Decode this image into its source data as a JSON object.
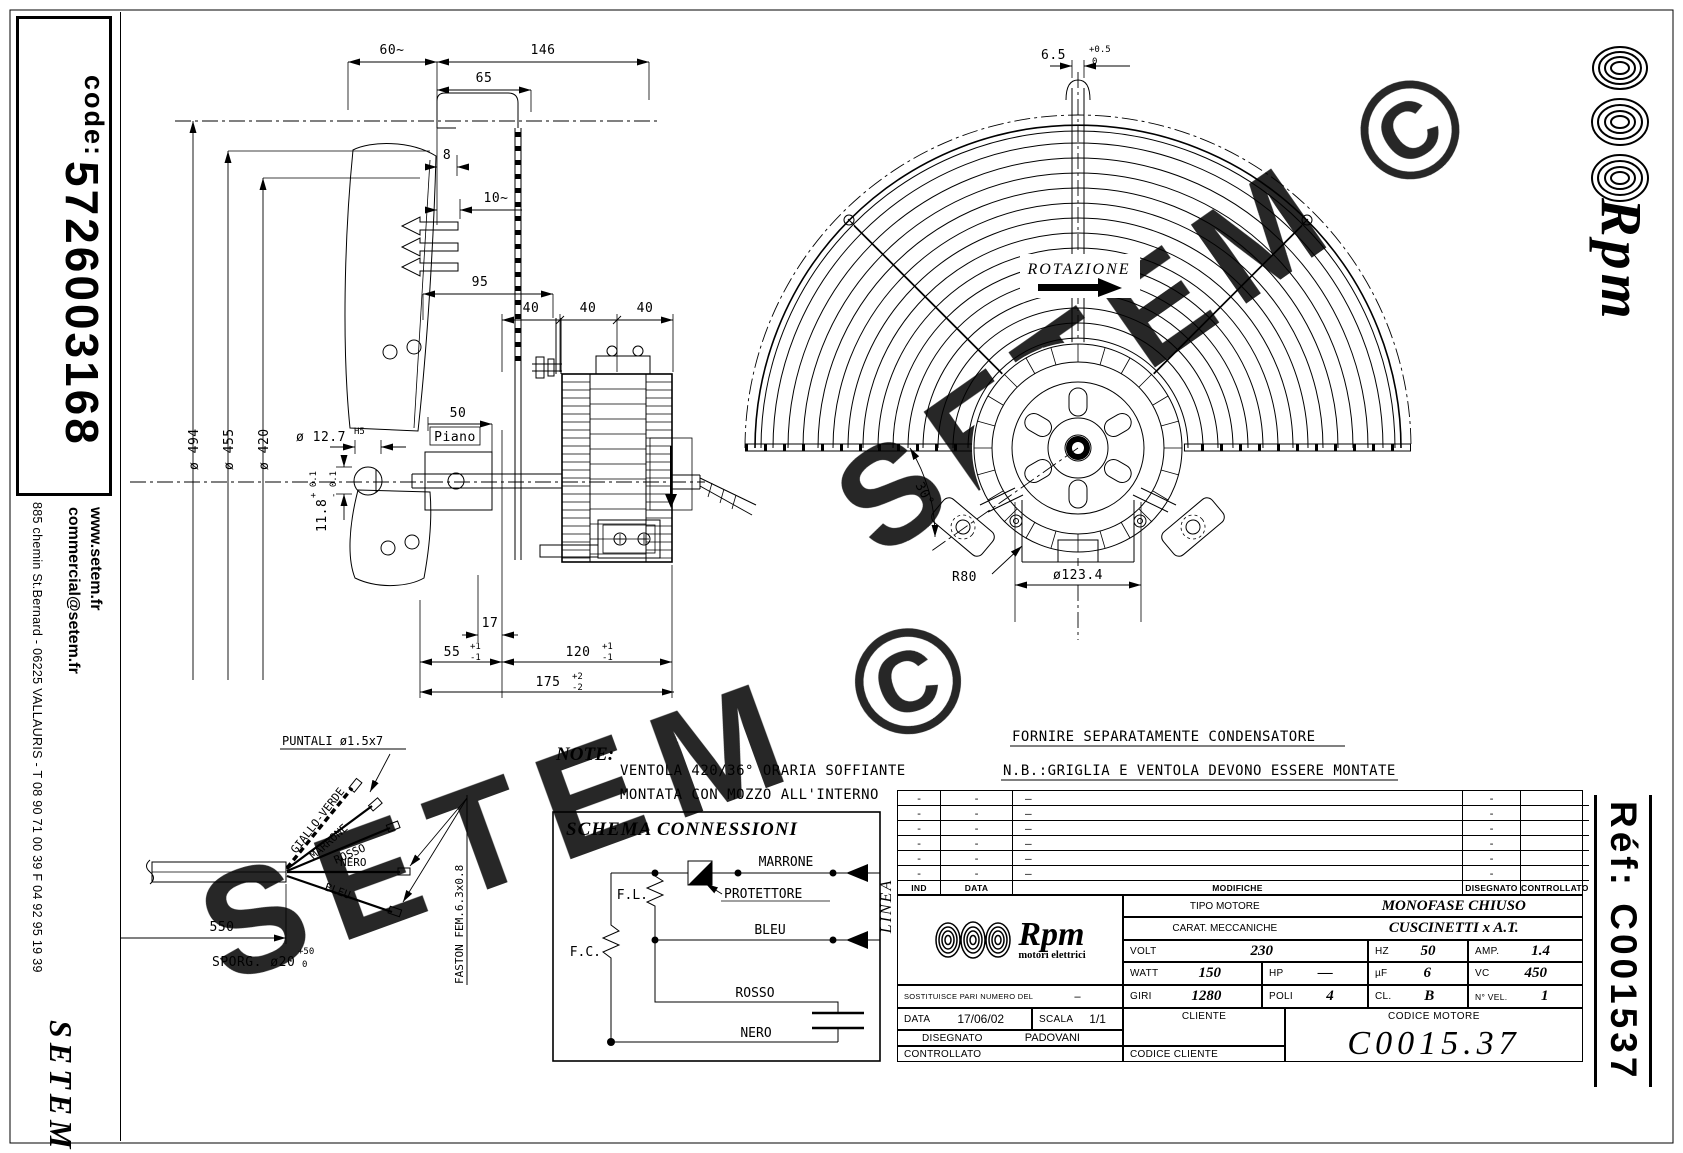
{
  "sidebar": {
    "code_label": "code:",
    "code_value": "5726003168",
    "website": "www.setem.fr",
    "email": "commercial@setem.fr",
    "address": "885 chemin St.Bernard  -  06225 VALLAURIS  -  T 08 90 71 00 39   F 04 92 95 19 39",
    "brand": "SETEM"
  },
  "watermark": {
    "text": "SETEM ©"
  },
  "right_rail": {
    "brand": "Rpm",
    "ref": "Réf:  C001537"
  },
  "side_view": {
    "dims": {
      "d60": "60~",
      "d146": "146",
      "d65": "65",
      "d8": "8",
      "d10": "10~",
      "d95": "95",
      "d40a": "40",
      "d40b": "40",
      "d40c": "40",
      "dia494": "ø 494",
      "dia455": "ø 455",
      "dia420": "ø 420",
      "dia127": "ø 12.7",
      "dia127_tol": "H5",
      "d118": "11.8",
      "d118_p": "+ 0.1",
      "d118_m": "- 0.1",
      "d50": "50",
      "piano": "Piano",
      "d17": "17",
      "d55": "55",
      "d55_p": "+1",
      "d55_m": "-1",
      "d120": "120",
      "d120_p": "+1",
      "d120_m": "-1",
      "d175": "175",
      "d175_p": "+2",
      "d175_m": "-2"
    }
  },
  "front_view": {
    "dims": {
      "d65t": "6.5",
      "d65t_p": "+0.5",
      "d65t_m": "0",
      "rotazione": "ROTAZIONE",
      "d30": "30°",
      "r80": "R80",
      "dia1234": "ø123.4"
    }
  },
  "cable_detail": {
    "puntali": "PUNTALI  ø1.5x7",
    "giallo": "GIALLO-VERDE",
    "marrone": "MARRONE",
    "rosso": "ROSSO",
    "nero": "NERO",
    "bleu": "BLEU",
    "d550": "550",
    "sporg": "SPORG. ø20",
    "sporg_p": "+50",
    "sporg_m": "0",
    "faston": "FASTON FEM.6.3x0.8"
  },
  "notes": {
    "note_label": "NOTE:",
    "note_line1": "VENTOLA 420/36° ORARIA SOFFIANTE",
    "note_line2": "MONTATA CON MOZZO ALL'INTERNO",
    "right_line1": "FORNIRE SEPARATAMENTE CONDENSATORE",
    "right_line2": "N.B.:GRIGLIA E VENTOLA DEVONO ESSERE MONTATE"
  },
  "schema": {
    "title": "SCHEMA CONNESSIONI",
    "fl": "F.L.",
    "fc": "F.C.",
    "marrone": "MARRONE",
    "protettore": "PROTETTORE",
    "bleu": "BLEU",
    "rosso": "ROSSO",
    "nero": "NERO",
    "linea": "LINEA"
  },
  "title_block": {
    "mod_headers": {
      "ind": "IND",
      "data": "DATA",
      "modifiche": "MODIFICHE",
      "disegnato": "DISEGNATO",
      "controllato": "CONTROLLATO"
    },
    "mod_rows": [
      {
        "ind": "-",
        "data": "-",
        "mod": "—",
        "dis": "-"
      },
      {
        "ind": "-",
        "data": "-",
        "mod": "—",
        "dis": "-"
      },
      {
        "ind": "-",
        "data": "-",
        "mod": "—",
        "dis": "-"
      },
      {
        "ind": "-",
        "data": "-",
        "mod": "—",
        "dis": "-"
      },
      {
        "ind": "-",
        "data": "-",
        "mod": "—",
        "dis": "-"
      },
      {
        "ind": "-",
        "data": "-",
        "mod": "—",
        "dis": "-"
      }
    ],
    "brand": {
      "name": "Rpm",
      "tagline": "motori elettrici"
    },
    "specs": {
      "tipo_label": "TIPO MOTORE",
      "tipo_value": "MONOFASE CHIUSO",
      "carat_label": "CARAT. MECCANICHE",
      "carat_value": "CUSCINETTI x A.T.",
      "volt_label": "VOLT",
      "volt": "230",
      "hz_label": "HZ",
      "hz": "50",
      "amp_label": "AMP.",
      "amp": "1.4",
      "watt_label": "WATT",
      "watt": "150",
      "hp_label": "HP",
      "hp": "—",
      "uf_label": "µF",
      "uf": "6",
      "vc_label": "VC",
      "vc": "450",
      "giri_label": "GIRI",
      "giri": "1280",
      "poli_label": "POLI",
      "poli": "4",
      "cl_label": "CL.",
      "cl": "B",
      "nvel_label": "N° VEL.",
      "nvel": "1"
    },
    "footer": {
      "sost_label": "SOSTITUISCE PARI NUMERO DEL",
      "sost_value": "–",
      "data_label": "DATA",
      "data_value": "17/06/02",
      "scala_label": "SCALA",
      "scala_value": "1/1",
      "cliente_label": "CLIENTE",
      "disegnato_label": "DISEGNATO",
      "disegnato_value": "PADOVANI",
      "controllato_label": "CONTROLLATO",
      "codice_cliente_label": "CODICE CLIENTE",
      "codice_motore_label": "CODICE MOTORE",
      "codice_motore_value": "C0015.37"
    }
  }
}
